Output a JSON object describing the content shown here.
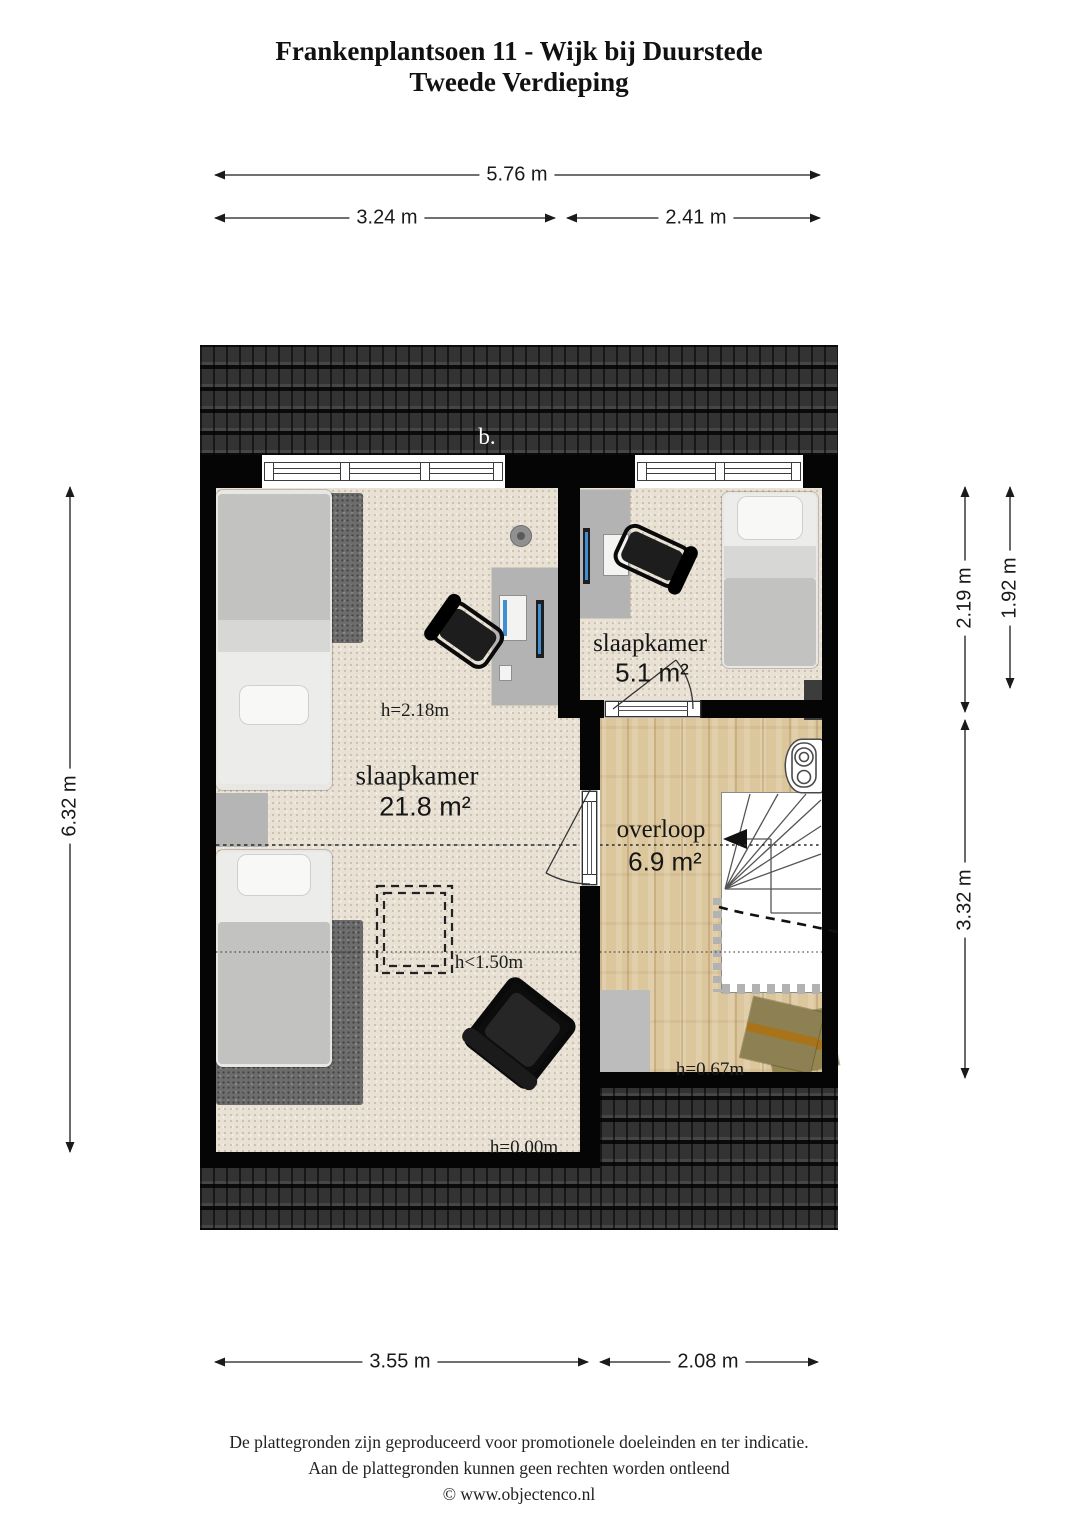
{
  "title": {
    "line1": "Frankenplantsoen 11 - Wijk bij Duurstede",
    "line2": "Tweede Verdieping"
  },
  "dimensions": {
    "top_total": "5.76 m",
    "top_left": "3.24 m",
    "top_right": "2.41 m",
    "left": "6.32 m",
    "right_top_inner": "2.19 m",
    "right_top_outer": "1.92 m",
    "right_bottom": "3.32 m",
    "bottom_left": "3.55 m",
    "bottom_right": "2.08 m"
  },
  "rooms": {
    "bedroom_large": {
      "name": "slaapkamer",
      "area": "21.8 m²"
    },
    "bedroom_small": {
      "name": "slaapkamer",
      "area": "5.1 m²"
    },
    "landing": {
      "name": "overloop",
      "area": "6.9 m²"
    }
  },
  "annotations": {
    "roof_label": "b.",
    "ceiling_height": "h=2.18m",
    "low_ceiling": "h<1.50m",
    "floor_height": "h=0.00m",
    "landing_height": "h=0.67m"
  },
  "footer": {
    "line1": "De plattegronden zijn geproduceerd voor promotionele doeleinden en ter indicatie.",
    "line2": "Aan de plattegronden kunnen geen rechten worden ontleend",
    "line3": "© www.objectenco.nl"
  },
  "colors": {
    "wall": "#050505",
    "roof": "#2d2d2d",
    "carpet": "#e8e1d4",
    "wood": "#dcc69c",
    "line": "#222222"
  }
}
